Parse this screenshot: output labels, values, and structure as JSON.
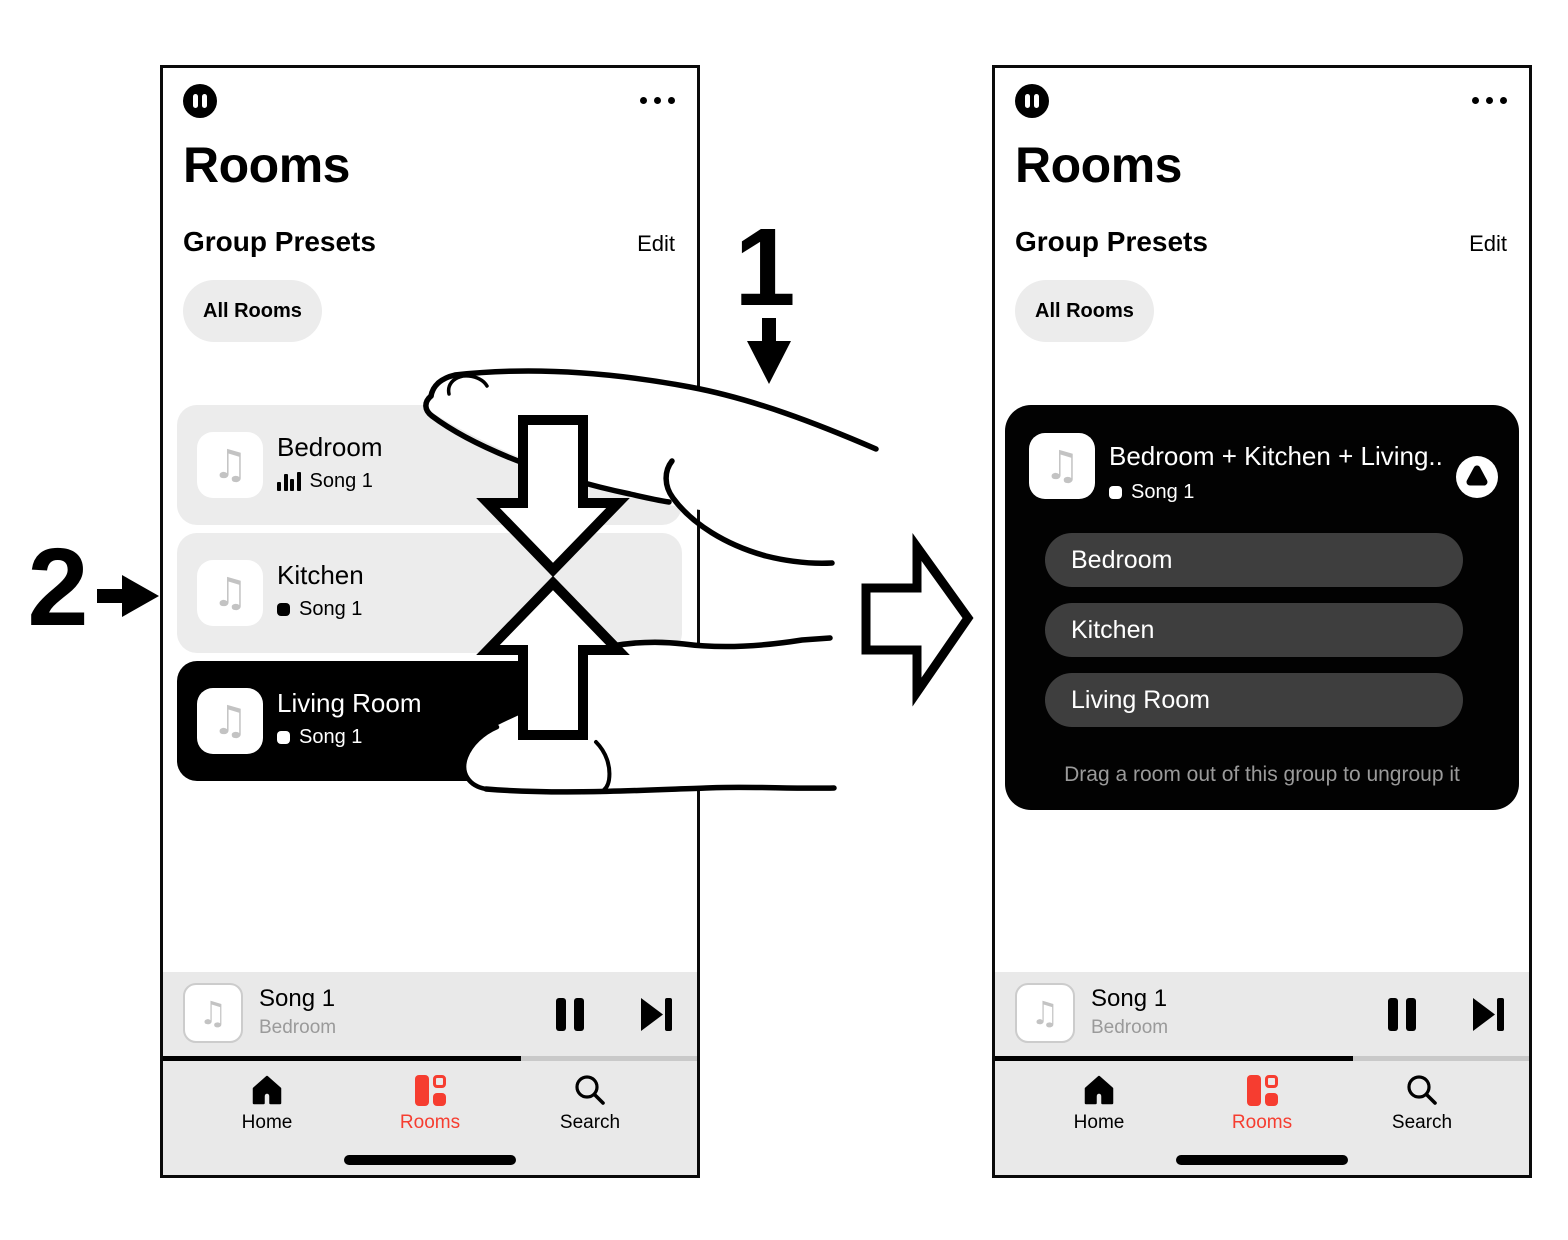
{
  "annotations": {
    "step1_label": "1",
    "step2_label": "2"
  },
  "icons": {
    "music_note": "♫",
    "status_icon": "pause-circle",
    "more_icon": "ellipsis",
    "group_badge": "droplet-circle",
    "now_playing_indicator": "equalizer-bars"
  },
  "colors": {
    "accent_red": "#f63d30",
    "card_gray": "#ececec",
    "dark_card": "#000000",
    "dark_row": "#3e3e3e",
    "muted_text": "#9a9a9a"
  },
  "nav": {
    "home": "Home",
    "rooms": "Rooms",
    "search": "Search"
  },
  "screens": {
    "left": {
      "title": "Rooms",
      "section_title": "Group Presets",
      "edit_label": "Edit",
      "preset_label": "All Rooms",
      "rooms": [
        {
          "name": "Bedroom",
          "song": "Song 1",
          "state": "playing"
        },
        {
          "name": "Kitchen",
          "song": "Song 1",
          "state": "idle"
        },
        {
          "name": "Living Room",
          "song": "Song 1",
          "state": "selected"
        }
      ],
      "player": {
        "song": "Song 1",
        "room": "Bedroom",
        "progress_pct": 67
      }
    },
    "right": {
      "title": "Rooms",
      "section_title": "Group Presets",
      "edit_label": "Edit",
      "preset_label": "All Rooms",
      "group": {
        "title": "Bedroom + Kitchen + Living..",
        "song": "Song 1",
        "rooms": [
          "Bedroom",
          "Kitchen",
          "Living Room"
        ],
        "hint": "Drag a room out of this group to ungroup it"
      },
      "player": {
        "song": "Song 1",
        "room": "Bedroom",
        "progress_pct": 67
      }
    }
  }
}
